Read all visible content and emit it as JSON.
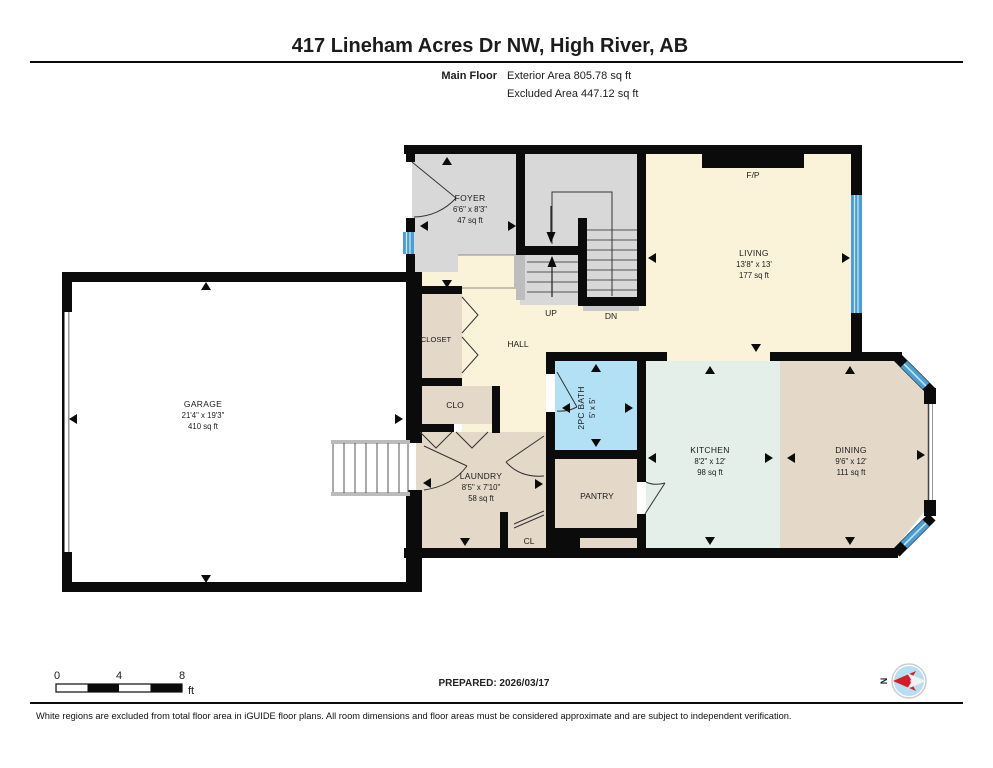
{
  "header": {
    "title": "417 Lineham Acres Dr NW, High River, AB",
    "floor_label": "Main Floor",
    "exterior_area": "Exterior Area 805.78 sq ft",
    "excluded_area": "Excluded Area 447.12 sq ft"
  },
  "rooms": {
    "garage": {
      "name": "GARAGE",
      "dims": "21'4\" x 19'3\"",
      "area": "410 sq ft"
    },
    "foyer": {
      "name": "FOYER",
      "dims": "6'6\" x 8'3\"",
      "area": "47 sq ft"
    },
    "living": {
      "name": "LIVING",
      "dims": "13'8\" x 13'",
      "area": "177 sq ft"
    },
    "kitchen": {
      "name": "KITCHEN",
      "dims": "8'2\" x 12'",
      "area": "98 sq ft"
    },
    "dining": {
      "name": "DINING",
      "dims": "9'6\" x 12'",
      "area": "111 sq ft"
    },
    "laundry": {
      "name": "LAUNDRY",
      "dims": "8'5\" x 7'10\"",
      "area": "58 sq ft"
    },
    "bath": {
      "name": "2PC BATH",
      "dims": "5' x 5'"
    },
    "hall": {
      "name": "HALL"
    },
    "closet": {
      "name": "CLOSET"
    },
    "clo": {
      "name": "CLO"
    },
    "cl": {
      "name": "CL"
    },
    "pantry": {
      "name": "PANTRY"
    },
    "fireplace": "F/P",
    "stairs_up": "UP",
    "stairs_down": "DN"
  },
  "footer": {
    "scale": {
      "tick0": "0",
      "tick4": "4",
      "tick8": "8",
      "unit": "ft"
    },
    "prepared": "PREPARED: 2026/03/17",
    "compass_north": "N",
    "disclaimer": "White regions are excluded from total floor area in iGUIDE floor plans. All room dimensions and floor areas must be considered approximate and are subject to independent verification."
  },
  "colors": {
    "wall": "#0b0b0b",
    "cream": "#faf3da",
    "grey": "#d8d8d8",
    "beige": "#e4d8c8",
    "mint": "#e3efe8",
    "bath_blue": "#b2e0f4",
    "window_blue": "#4a9ed6",
    "compass_red": "#d71d24",
    "compass_fill": "#b5dff2"
  }
}
